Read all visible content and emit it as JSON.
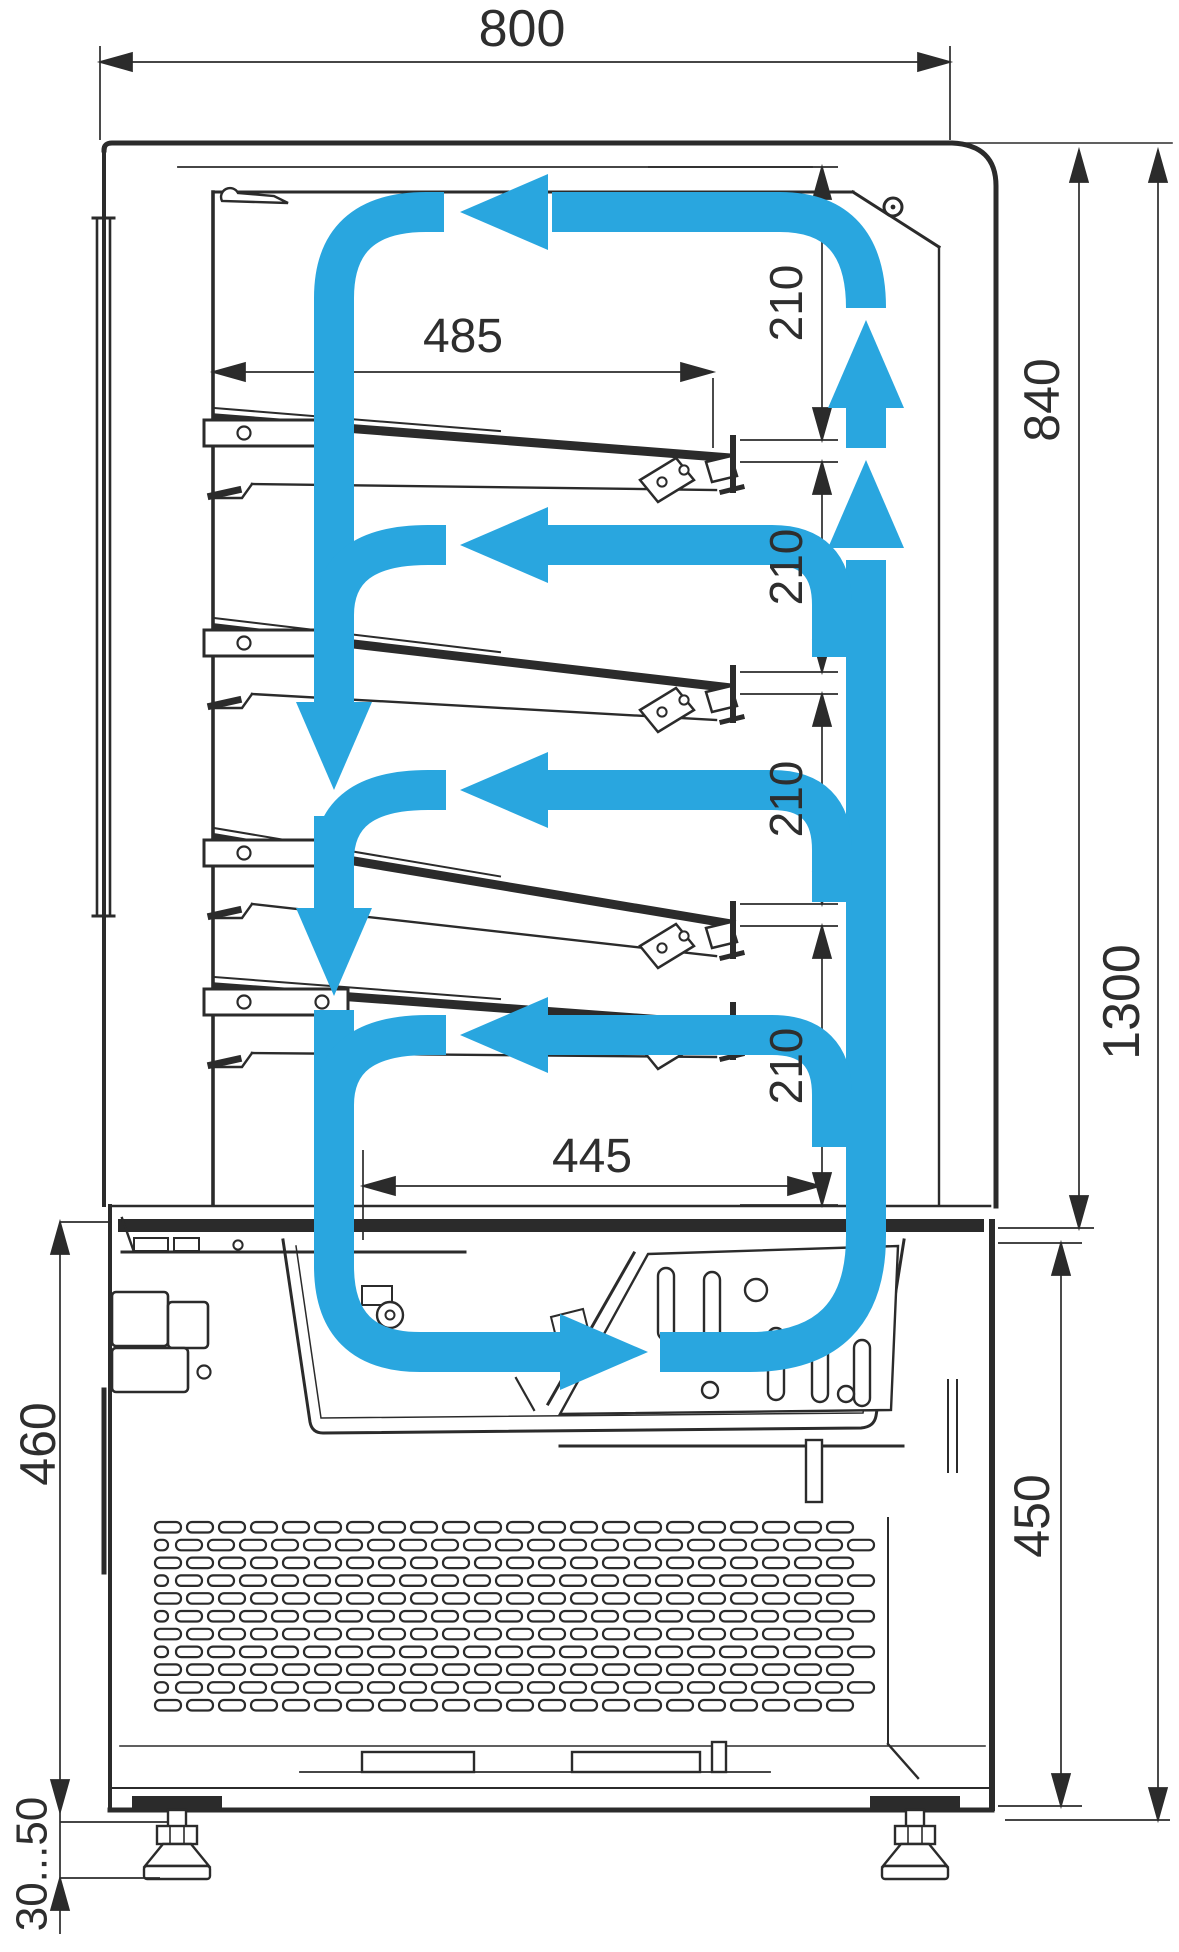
{
  "drawing": {
    "background": "#ffffff",
    "stroke_color": "#2b2b2b",
    "airflow_color": "#29a6df",
    "dims": {
      "overall_width": "800",
      "shelf_length": "485",
      "bottom_shelf_length": "445",
      "shelf_gaps": [
        "210",
        "210",
        "210",
        "210"
      ],
      "case_height": "840",
      "overall_height": "1300",
      "base_height_left": "460",
      "base_height_right": "450",
      "legs_adjustment": "30...50"
    }
  }
}
